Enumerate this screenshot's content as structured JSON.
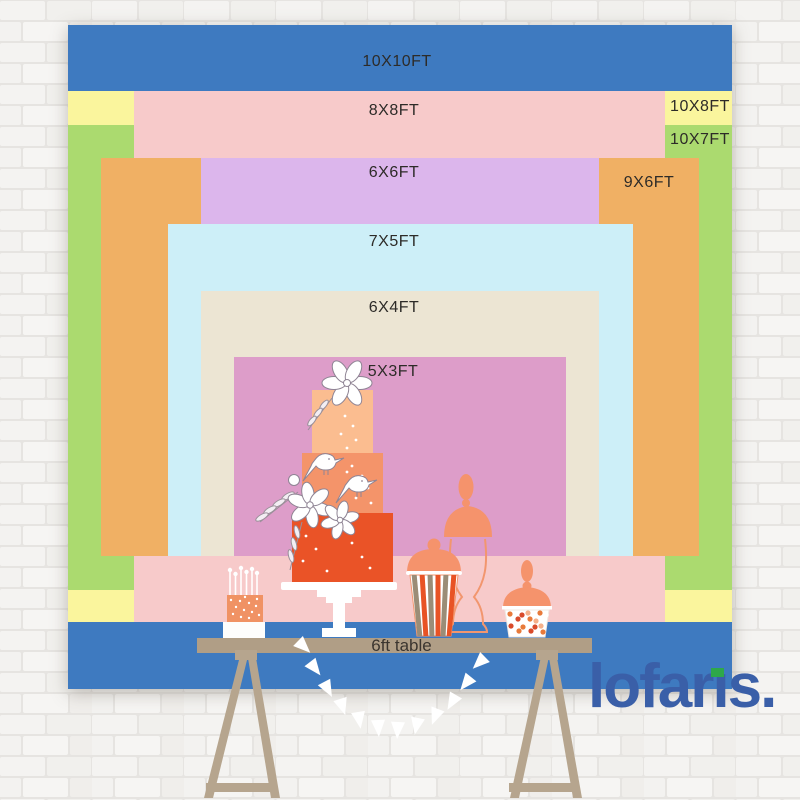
{
  "sizes": [
    {
      "label": "10X10FT",
      "color": "#3e7ac0"
    },
    {
      "label": "8X8FT",
      "color": "#f7caca"
    },
    {
      "label": "10X8FT",
      "color": "#faf59d"
    },
    {
      "label": "10X7FT",
      "color": "#abda6f"
    },
    {
      "label": "6X6FT",
      "color": "#dcb6ec"
    },
    {
      "label": "9X6FT",
      "color": "#f0b064"
    },
    {
      "label": "7X5FT",
      "color": "#cdeff8"
    },
    {
      "label": "6X4FT",
      "color": "#ece5d3"
    },
    {
      "label": "5X3FT",
      "color": "#dd9dc9"
    }
  ],
  "table": {
    "label": "6ft table"
  },
  "brand": {
    "name": "lofaris",
    "period": ".",
    "color": "#3a5fa8",
    "accent_color": "#2ea84a"
  }
}
